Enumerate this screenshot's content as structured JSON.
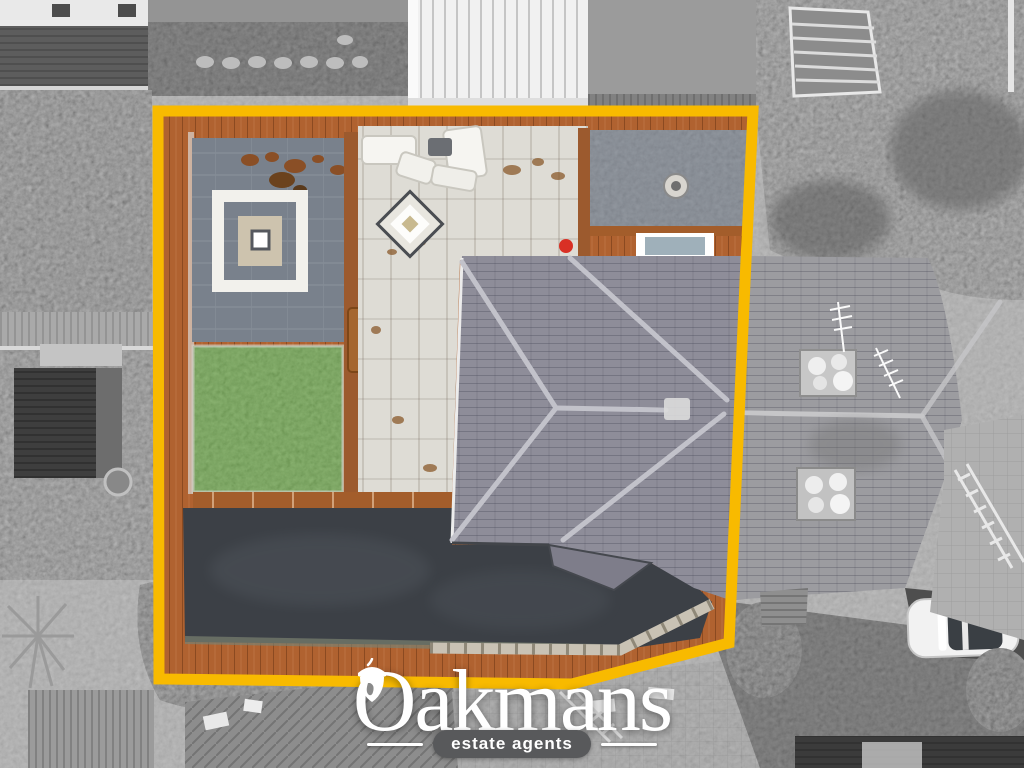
{
  "brand": {
    "name": "Oakmans",
    "tagline": "estate agents"
  },
  "palette": {
    "boundary": "#F8BA00",
    "lawn": "#5F9C3A",
    "deck": "#B06230",
    "roof": "#8E8D99",
    "roof_gray": "#9C9CA0",
    "paving": "#DEDCD5",
    "slate": "#79818C",
    "driveway": "#3C4046",
    "logo_text": "#FFFFFF",
    "tagline_bg": "#58595B"
  }
}
